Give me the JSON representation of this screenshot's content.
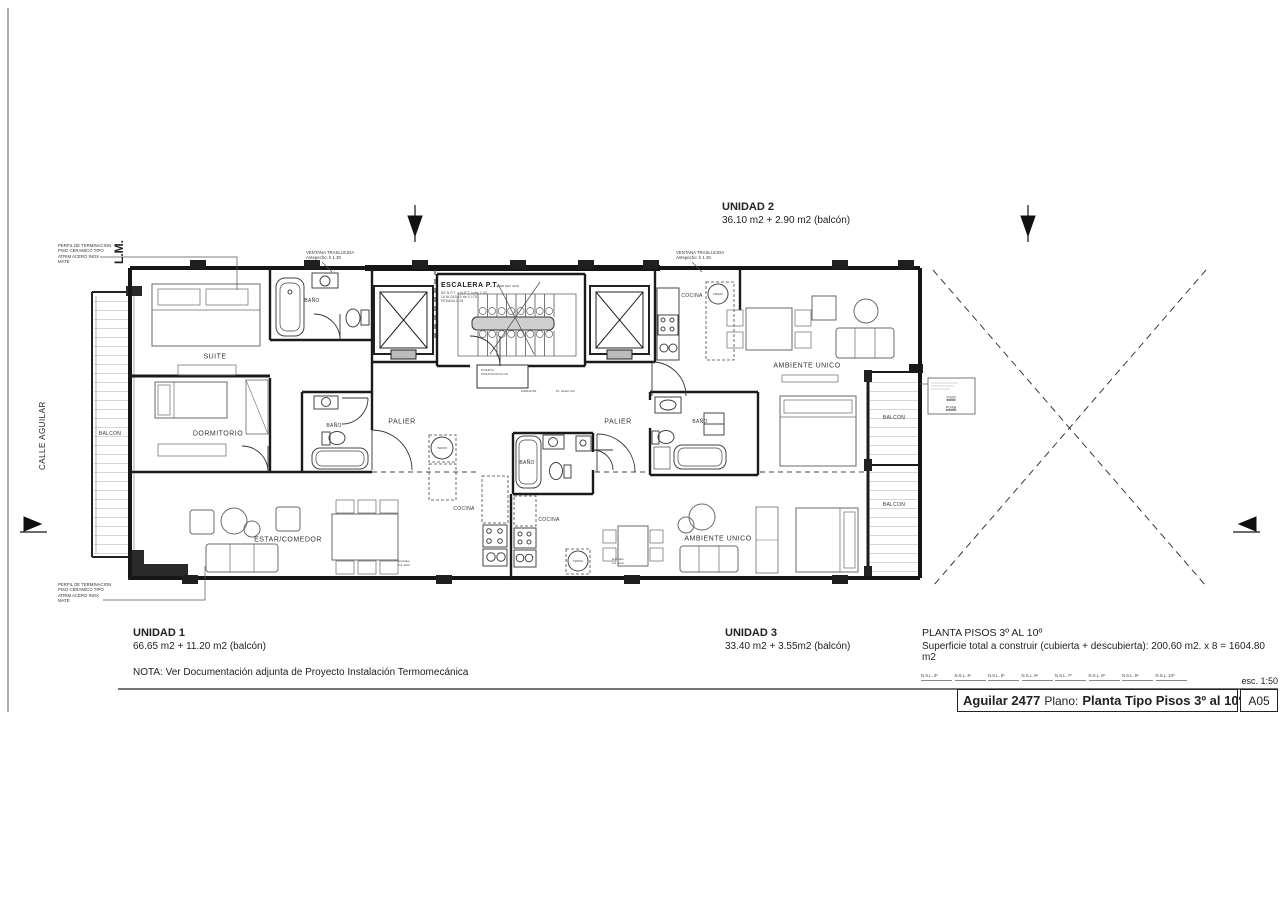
{
  "sheet": {
    "scale_label": "esc. 1:50",
    "project": "Aguilar 2477",
    "plano_label": "Plano:",
    "plano_value": "Planta Tipo Pisos 3º al 10º",
    "date": "06-09-2023",
    "code": "A05",
    "nsl": [
      "N.S.L. 3º",
      "N.S.L. 4º",
      "N.S.L. 5º",
      "N.S.L. 6º",
      "N.S.L. 7º",
      "N.S.L. 8º",
      "N.S.L. 9º",
      "N.S.L. 10º"
    ]
  },
  "units": {
    "u1": {
      "name": "UNIDAD 1",
      "area": "66.65 m2 + 11.20 m2 (balcón)"
    },
    "u2": {
      "name": "UNIDAD 2",
      "area": "36.10 m2 + 2.90 m2 (balcón)"
    },
    "u3": {
      "name": "UNIDAD 3",
      "area": "33.40 m2 + 3.55m2 (balcón)"
    }
  },
  "summary": {
    "title": "PLANTA PISOS 3º AL 10º",
    "detail": "Superficie total a construir (cubierta + descubierta): 200.60 m2. x 8 = 1604.80 m2"
  },
  "nota": "NOTA: Ver Documentación adjunta  de Proyecto Instalación Termomecánica",
  "site": {
    "lm": "L.M.",
    "calle": "CALLE AGUILAR",
    "perfil_note": "PERFIL DE TERMINACION\nPISO CERAMICO TIPO\nATRIM ACERO INOX\nMATE",
    "ventana_note": "VENTANA TRASLUCIDA\nAntepecho: h 1.30"
  },
  "rooms": {
    "suite": "SUITE",
    "dormitorio": "DORMITORIO",
    "estar_comedor": "ESTAR/COMEDOR",
    "palier": "PALIER",
    "bano": "BAÑO",
    "cocina": "COCINA",
    "ambiente_unico": "AMBIENTE UNICO",
    "balcon": "BALCON",
    "termo": "TERMO"
  },
  "stair": {
    "title": "ESCALERA P.T.",
    "det_ref": "(VER DET. 02/3)",
    "specs": "DE N.P.T. a N.P.T. sube 2.40\n16 ALZADAS de 0.175\nPEDADA 0.28",
    "puerta": "PUERTA\nPRESURIZACION",
    "hidrante": "HIDRANTE",
    "pl_elec": "PL. ELEC./LD"
  },
  "misc": {
    "v100": "V100",
    "portal": "Portal",
    "enchape": "Enchape\nind. alum."
  }
}
